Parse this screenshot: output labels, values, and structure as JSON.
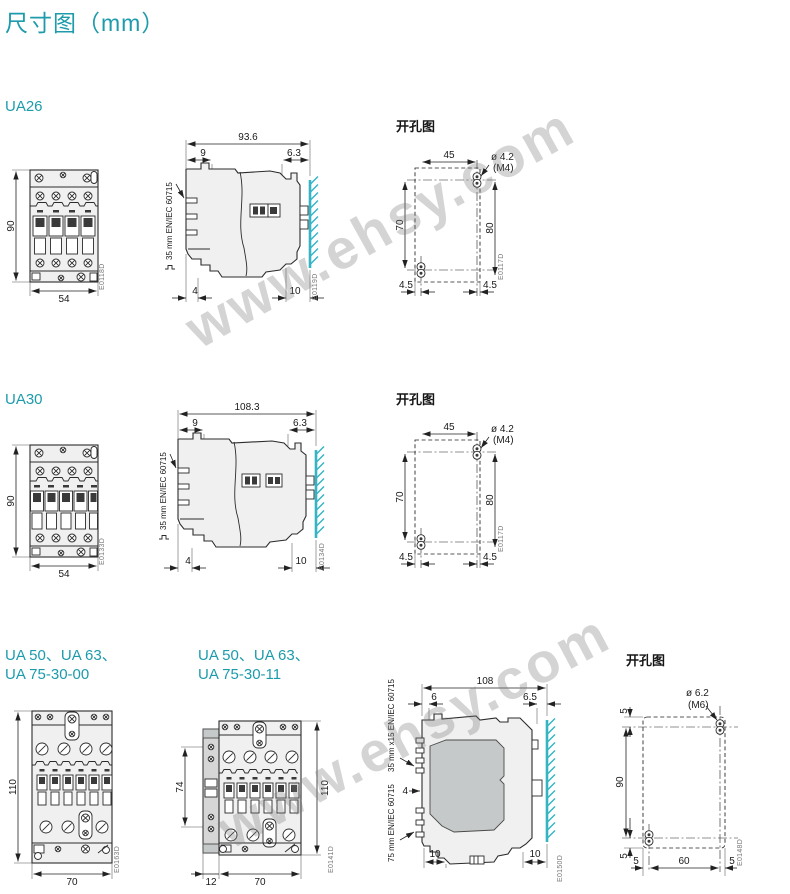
{
  "page": {
    "title": "尺寸图（mm）"
  },
  "watermark": {
    "text": "www.ehsy.com"
  },
  "sections": {
    "ua26": {
      "label": "UA26",
      "front": {
        "height": "90",
        "width": "54",
        "code": "E0118D"
      },
      "side": {
        "total": "93.6",
        "top_left": "9",
        "top_right": "6.3",
        "bottom_left": "4",
        "bottom_right": "10",
        "rail_label": "35 mm EN/IEC 60715",
        "code": "E0119D"
      },
      "drill": {
        "title": "开孔图",
        "top": "45",
        "hole_dia": "ø 4.2",
        "hole_thread": "(M4)",
        "left": "70",
        "right": "80",
        "bottom_left": "4.5",
        "bottom_right": "4.5",
        "code": "E0117D"
      }
    },
    "ua30": {
      "label": "UA30",
      "front": {
        "height": "90",
        "width": "54",
        "code": "E0133D"
      },
      "side": {
        "total": "108.3",
        "top_left": "9",
        "top_right": "6.3",
        "bottom_left": "4",
        "bottom_right": "10",
        "rail_label": "35 mm EN/IEC 60715",
        "code": "E0134D"
      },
      "drill": {
        "title": "开孔图",
        "top": "45",
        "hole_dia": "ø 4.2",
        "hole_thread": "(M4)",
        "left": "70",
        "right": "80",
        "bottom_left": "4.5",
        "bottom_right": "4.5",
        "code": "E0117D"
      }
    },
    "ua50": {
      "label_left_line1": "UA 50、UA 63、",
      "label_left_line2": "UA 75-30-00",
      "label_right_line1": "UA 50、UA 63、",
      "label_right_line2": "UA 75-30-11",
      "front00": {
        "height": "110",
        "width": "70",
        "code": "E0163D"
      },
      "front11": {
        "aux_height": "74",
        "height": "110",
        "aux_width": "12",
        "width": "70",
        "code": "E0141D"
      },
      "side": {
        "total": "108",
        "top_left": "6",
        "top_right": "6.5",
        "mid": "4",
        "bottom_left": "10",
        "bottom_right": "10",
        "rail_top": "35 mm x15 EN/IEC 60715",
        "rail_bottom": "75 mm EN/IEC 60715",
        "code": "E0150D"
      },
      "drill": {
        "title": "开孔图",
        "hole_dia": "ø 6.2",
        "hole_thread": "(M6)",
        "top": "5",
        "left": "90",
        "bottom": "5",
        "b_left": "5",
        "b_center": "60",
        "b_right": "5",
        "code": "E0148D"
      }
    }
  }
}
